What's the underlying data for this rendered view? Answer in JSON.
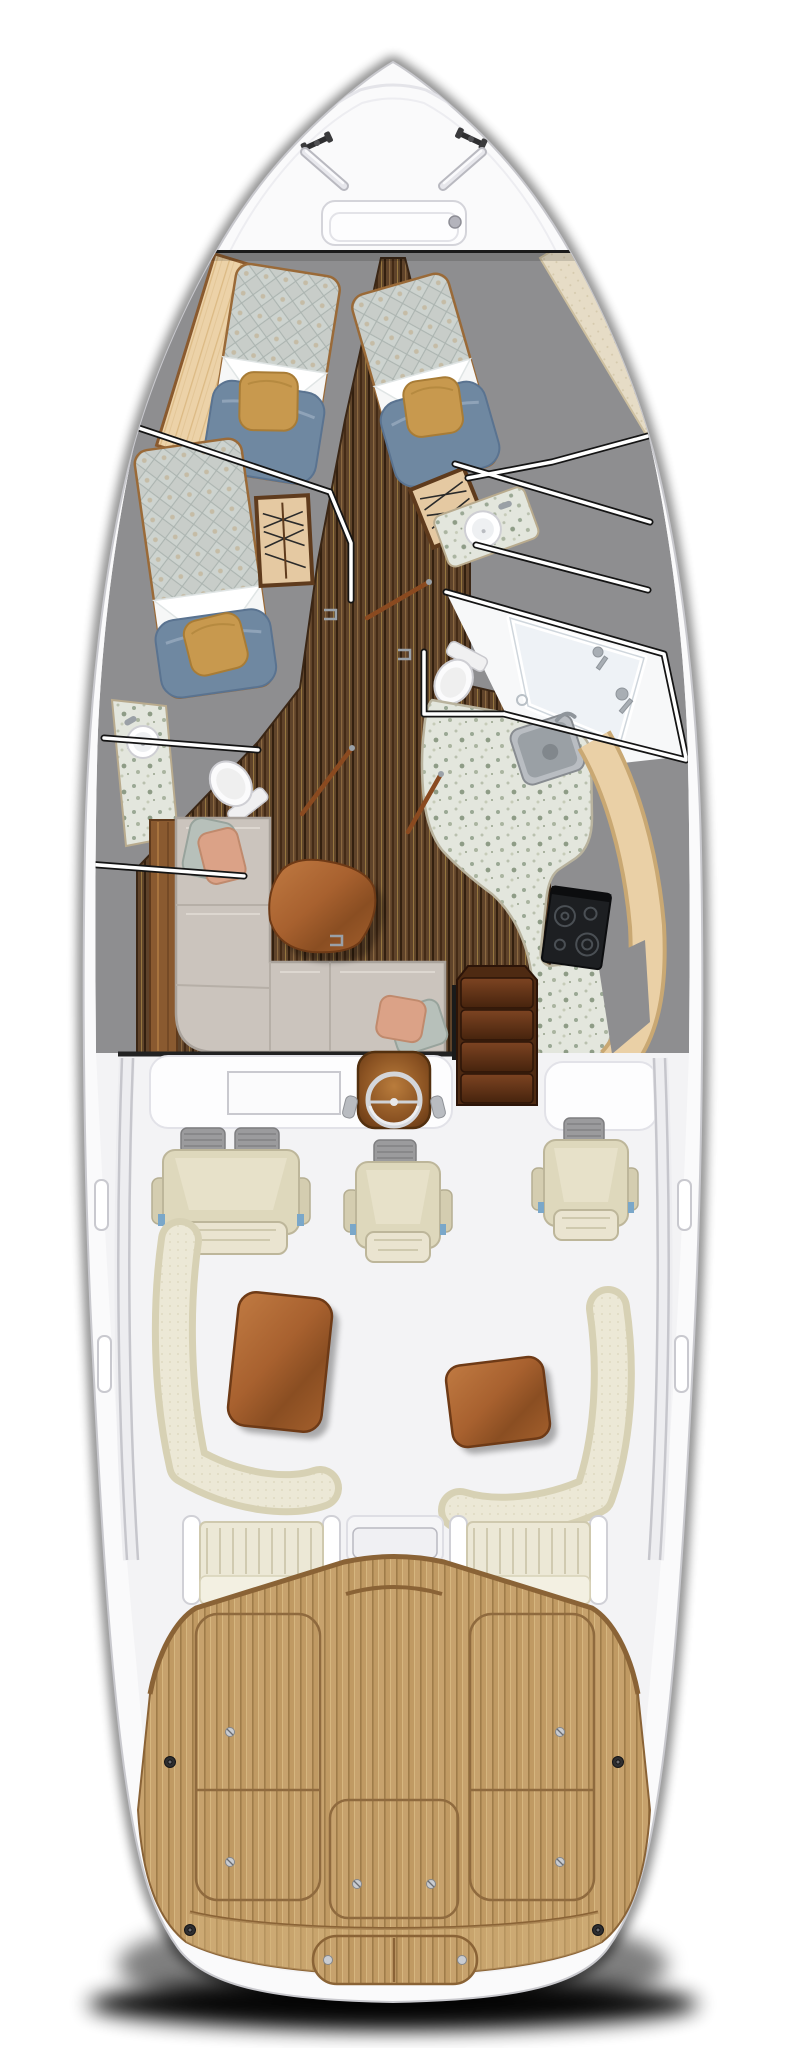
{
  "meta": {
    "description": "Top-down yacht floor plan rendering, bow at top and teak swim deck at stern",
    "orientation": "bow-up"
  },
  "colors": {
    "page_bg": "#ffffff",
    "hull_white": "#fafafb",
    "hull_rim_line": "#dcdce1",
    "shadow_black": "#000000",
    "cutaway_gray": "#8e8e90",
    "cut_line_black": "#1a1a1a",
    "sole_teak_dark": "#5f432a",
    "sole_stripe_light": "#8a6840",
    "cockpit_teak": "#c7a26d",
    "caulk_brown": "#8a6336",
    "terrazzo_counter": "#e3e6dd",
    "maple_wood": "#ead0a6",
    "quilt_fabric": "#c8cdc9",
    "duvet_blue": "#6f88a1",
    "pillow_gold": "#c8994e",
    "linen_white": "#f6f7f7",
    "sofa_beige": "#cbc4bd",
    "cushion_sage": "#b7c0ba",
    "cushion_peach": "#dba287",
    "table_wood": "#a8612f",
    "stair_wood": "#5a2f14",
    "seat_cream": "#ded8bc",
    "seat_cream_light": "#ece8d6",
    "seat_trim_tan": "#d7d1b4",
    "headrest_gray": "#9b9b9d",
    "steel_gray": "#c9ccd1",
    "cooktop_black": "#1d1f22",
    "fixture_white": "#f7f8f9",
    "shower_glass": "#eef2f6"
  },
  "regions": {
    "bow_deck": {
      "cleats": 2,
      "grab_rails": 2,
      "anchor_hatches": 1
    },
    "forward_cabin": {
      "v_berths": 2,
      "hanging_lockers": 2,
      "vanity_sinks": 1
    },
    "port_guest_cabin": {
      "berths": 1
    },
    "heads": {
      "compartments": 2,
      "toilets": 2,
      "sinks": 2,
      "showers": 1
    },
    "galley": {
      "sinks": 1,
      "cooktop_burners": 4,
      "counters": 2
    },
    "salon": {
      "sofa_sections": 4,
      "throw_pillows": 4,
      "coffee_tables": 1
    },
    "helm": {
      "chairs": 3,
      "double_wide_seats": 1,
      "steering_wheels": 1,
      "instrument_panels": 1,
      "companionway_steps": 4
    },
    "cockpit": {
      "settees": 2,
      "wood_tables": 2,
      "aft_benches": 2,
      "engine_hatch_consoles": 1,
      "gunwale_handles": 4
    },
    "aft_deck": {
      "deck_hatches": 3,
      "transom_hatches": 1,
      "hatch_screws": 6,
      "deck_plugs": 4
    }
  }
}
